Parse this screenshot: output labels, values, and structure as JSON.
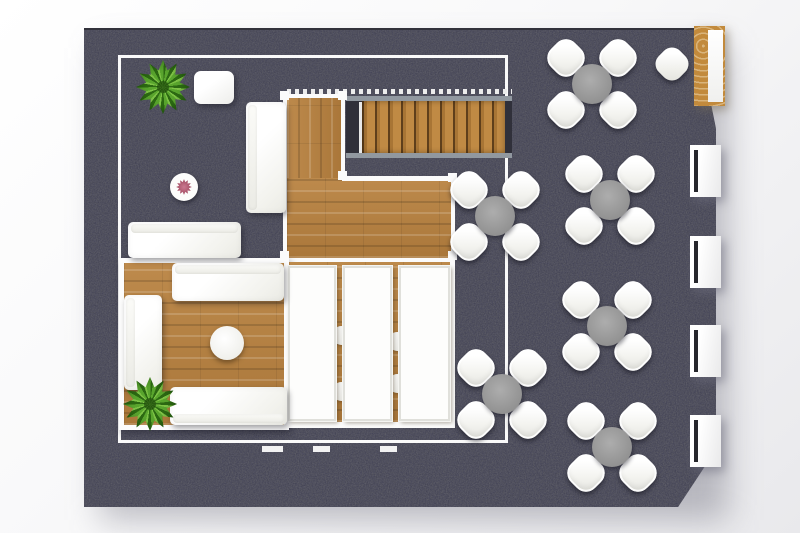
{
  "meta": {
    "description": "Top-down 3D rendered floor plan of a lounge / cafe interior: dark carpet, wood platforms, white lounge sofas, long white tables, cross-shaped dining sets, staircase, bar counter and wall benches",
    "canvas": {
      "width": 800,
      "height": 533
    }
  },
  "palette": {
    "carpet": "#494951",
    "carpet_edge": "#32323b",
    "wood": "#b5813e",
    "wood_light": "#c6934f",
    "wood_dark": "#a0702f",
    "wall_white": "#fbfbfb",
    "furniture_white": "#ffffff",
    "dining_table_gray": "#9c9c9c",
    "rail_gray": "#9198a0",
    "bar_wood": "#c28a3c",
    "plant_green": "#5aa62e",
    "flower_pink": "#b55a74",
    "background_start": "#ffffff",
    "background_end": "#e9e9ec"
  },
  "areas": {
    "carpet_shadow": {
      "x": 100,
      "y": 48,
      "w": 628,
      "h": 472
    },
    "carpet": {
      "x": 84,
      "y": 28,
      "w": 632,
      "h": 479
    },
    "frame": {
      "x": 118,
      "y": 55,
      "w": 390,
      "h": 388
    },
    "landing": {
      "x": 283,
      "y": 94,
      "w": 62,
      "h": 88
    },
    "wide_block": {
      "x": 283,
      "y": 178,
      "w": 172,
      "h": 84
    },
    "block_top_border": {
      "x": 342,
      "y": 176,
      "w": 113,
      "h": 5
    },
    "room": {
      "x": 119,
      "y": 258,
      "w": 170,
      "h": 172
    },
    "tables_area": {
      "x": 289,
      "y": 262,
      "w": 166,
      "h": 166
    },
    "stairs_dash": {
      "x": 287,
      "y": 89,
      "w": 225,
      "h": 5
    },
    "stairs_top_rail": {
      "x": 346,
      "y": 96,
      "w": 166,
      "h": 5
    },
    "stairs_well": {
      "x": 346,
      "y": 101,
      "w": 166,
      "h": 52
    },
    "stairs_stringer": {
      "x": 359,
      "y": 102,
      "w": 3,
      "h": 51
    },
    "stairs_treads": {
      "x": 362,
      "y": 101,
      "w": 143,
      "h": 52
    },
    "stairs_bottom_rail": {
      "x": 346,
      "y": 153,
      "w": 166,
      "h": 5
    },
    "bar": {
      "x": 694,
      "y": 26,
      "w": 31,
      "h": 80
    }
  },
  "structure": {
    "posts": [
      [
        280,
        91
      ],
      [
        338,
        91
      ],
      [
        338,
        171
      ],
      [
        448,
        173
      ],
      [
        448,
        251
      ],
      [
        280,
        251
      ]
    ],
    "floor_ticks": [
      {
        "x": 262,
        "y": 446,
        "w": 21
      },
      {
        "x": 313,
        "y": 446,
        "w": 17
      },
      {
        "x": 380,
        "y": 446,
        "w": 17
      }
    ]
  },
  "furniture": {
    "dining_sets": [
      {
        "id": "dining-set-1",
        "cx": 592,
        "cy": 84
      },
      {
        "id": "dining-set-2",
        "cx": 495,
        "cy": 216
      },
      {
        "id": "dining-set-3",
        "cx": 610,
        "cy": 200
      },
      {
        "id": "dining-set-4",
        "cx": 607,
        "cy": 326
      },
      {
        "id": "dining-set-5",
        "cx": 502,
        "cy": 394
      },
      {
        "id": "dining-set-6",
        "cx": 612,
        "cy": 447
      }
    ],
    "chairs_per_set": 4,
    "wall_benches": [
      {
        "id": "wall-bench-1",
        "x": 690,
        "y": 145
      },
      {
        "id": "wall-bench-2",
        "x": 690,
        "y": 236
      },
      {
        "id": "wall-bench-3",
        "x": 690,
        "y": 325
      },
      {
        "id": "wall-bench-4",
        "x": 690,
        "y": 415
      }
    ],
    "sofas": [
      {
        "id": "sofa-window",
        "x": 246,
        "y": 102,
        "w": 40,
        "h": 111,
        "back": "left"
      },
      {
        "id": "sofa-lounge-outer",
        "x": 128,
        "y": 222,
        "w": 113,
        "h": 36,
        "back": "top"
      },
      {
        "id": "sofa-room-top",
        "x": 172,
        "y": 263,
        "w": 112,
        "h": 38,
        "back": "top"
      },
      {
        "id": "sofa-room-left",
        "x": 124,
        "y": 295,
        "w": 38,
        "h": 95,
        "back": "left"
      },
      {
        "id": "sofa-room-bottom",
        "x": 170,
        "y": 387,
        "w": 117,
        "h": 38,
        "back": "bottom"
      }
    ],
    "long_tables": [
      {
        "id": "long-table-1",
        "x": 288,
        "y": 266,
        "w": 48,
        "h": 155
      },
      {
        "id": "long-table-2",
        "x": 343,
        "y": 266,
        "w": 49,
        "h": 155
      },
      {
        "id": "long-table-3",
        "x": 399,
        "y": 266,
        "w": 51,
        "h": 155
      }
    ],
    "tucked_chairs": [
      {
        "id": "tucked-chair-1",
        "cx": 341,
        "cy": 335
      },
      {
        "id": "tucked-chair-2",
        "cx": 341,
        "cy": 391
      },
      {
        "id": "tucked-chair-3",
        "cx": 397,
        "cy": 341
      },
      {
        "id": "tucked-chair-4",
        "cx": 397,
        "cy": 383
      }
    ],
    "plants": [
      {
        "id": "plant-entry",
        "cx": 163,
        "cy": 87,
        "r": 27
      },
      {
        "id": "plant-lounge",
        "cx": 150,
        "cy": 404,
        "r": 27
      }
    ],
    "small_items": [
      {
        "id": "ottoman",
        "type": "ottoman",
        "x": 194,
        "y": 71,
        "w": 40,
        "h": 33
      },
      {
        "id": "flower-table",
        "type": "flower-table",
        "cx": 184,
        "cy": 187,
        "r": 14
      },
      {
        "id": "coffee-table",
        "type": "coffee-table",
        "cx": 227,
        "cy": 343,
        "r": 17
      },
      {
        "id": "bar-chair",
        "type": "bar-chair",
        "cx": 672,
        "cy": 64
      }
    ]
  }
}
